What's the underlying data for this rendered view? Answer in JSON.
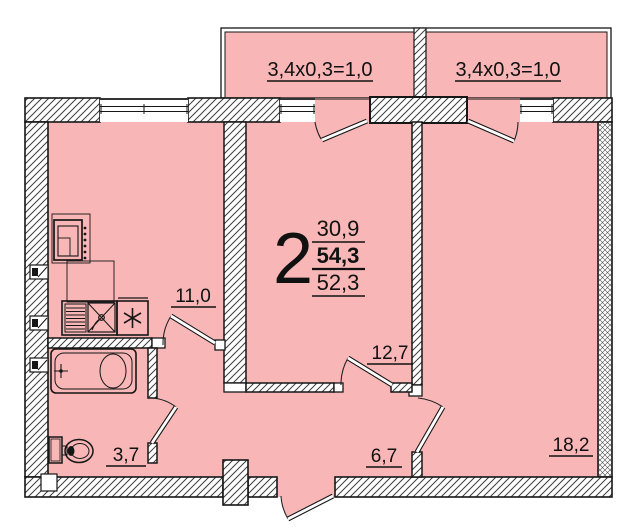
{
  "title": "2-room apartment floor plan",
  "colors": {
    "room_fill": "#f8b6b6",
    "line": "#161616",
    "hatch": "#3d3d3d"
  },
  "balconies": [
    {
      "label": "3,4x0,3=1,0"
    },
    {
      "label": "3,4x0,3=1,0"
    }
  ],
  "summary": {
    "room_count": "2",
    "living_area": "30,9",
    "total_area": "54,3",
    "reduced_area": "52,3"
  },
  "rooms": {
    "kitchen": {
      "area": "11,0"
    },
    "bathroom": {
      "area": "3,7"
    },
    "living": {
      "area": "12,7"
    },
    "hall": {
      "area": "6,7"
    },
    "bedroom": {
      "area": "18,2"
    }
  }
}
